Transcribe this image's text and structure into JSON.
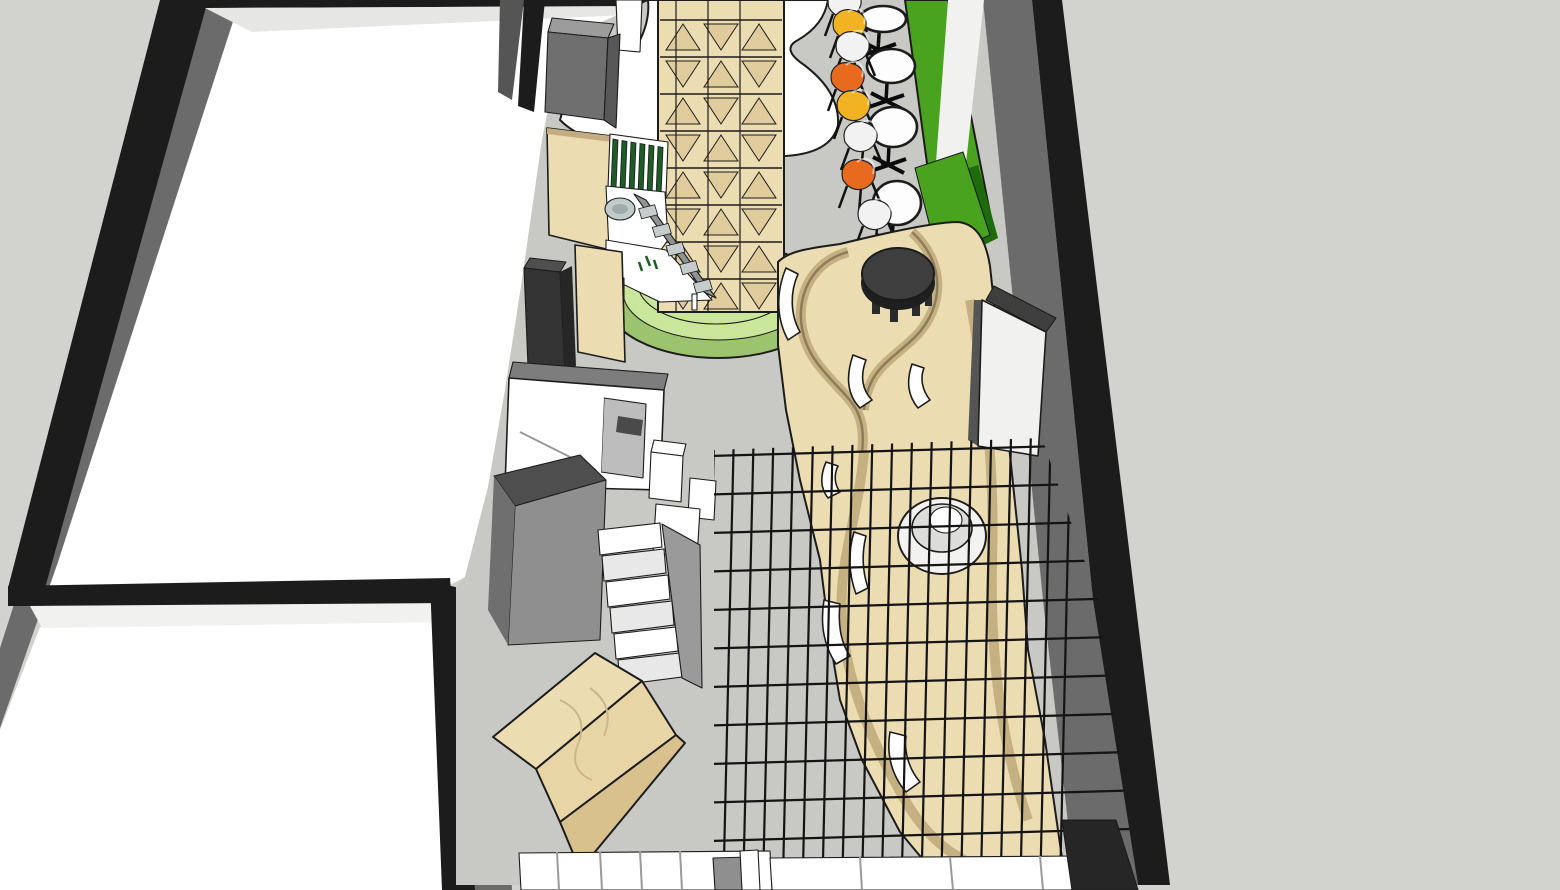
{
  "palette": {
    "bg": "#d2d2ce",
    "floor": "#c8c8c4",
    "wallFace": "#6b6b6b",
    "wallFaceLight": "#9a9a9a",
    "ink": "#1c1c1c",
    "wallBand": "#e6e6e4",
    "white": "#ffffff",
    "offWhite": "#f1f1ef",
    "plywood": "#ecdcb2",
    "plywoodMid": "#e0cb9c",
    "plywoodSide": "#c3ad80",
    "plywoodDark": "#8d7c59",
    "greenBase": "#c9e69b",
    "greenBaseDark": "#9cc46e",
    "greenWall": "#4aa31e",
    "greenWallDark": "#1e6b0d",
    "greenSlats": "#1d5c26",
    "chairOrange": "#e86a1e",
    "chairYellow": "#f2b322",
    "chairWhite": "#f2f2f2",
    "chairGray": "#c9c9c9",
    "tableWhite": "#fdfdfd",
    "darkTable": "#3f3f3f",
    "grid": "#141414",
    "boxDark": "#333333",
    "boxMid": "#8f8f8f",
    "sink": "#c2cbcb"
  },
  "scene": {
    "view": "3d-model-perspective",
    "objects": {
      "left_room": {
        "floor_color_key": "white"
      },
      "lower_room": {
        "floor_color_key": "white"
      },
      "corridor": {
        "floor_color_key": "floor"
      },
      "display_tower": {
        "material_key": "plywood",
        "base": {
          "shape": "round-steps",
          "color_key": "greenBase"
        }
      },
      "green_bench_wall": {
        "color_key": "greenWall"
      },
      "cafe_tables": {
        "count": 4,
        "top_color_key": "tableWhite",
        "base_color_key": "ink"
      },
      "cafe_chairs": {
        "count": 8,
        "colors": [
          "chairWhite",
          "chairYellow",
          "chairWhite",
          "chairOrange",
          "chairYellow",
          "chairWhite",
          "chairOrange",
          "chairWhite"
        ]
      },
      "s_curve_seating": {
        "material_key": "plywood",
        "cushions": {
          "count": 7,
          "color_key": "white"
        }
      },
      "round_coffee_table": {
        "color_key": "darkTable"
      },
      "mesh_canopy": {
        "line_color_key": "grid"
      },
      "round_planter_ring": {
        "color_key": "white"
      },
      "plywood_cube": {
        "material_key": "plywood"
      },
      "staircase": {
        "step_color_key": "white"
      },
      "service_counter": {
        "material_key": "plywood",
        "sink_color_key": "sink",
        "screen_color_key": "greenSlats"
      },
      "window_room": {
        "color_key": "white"
      },
      "wall_panel": {
        "color_key": "offWhite"
      }
    }
  }
}
